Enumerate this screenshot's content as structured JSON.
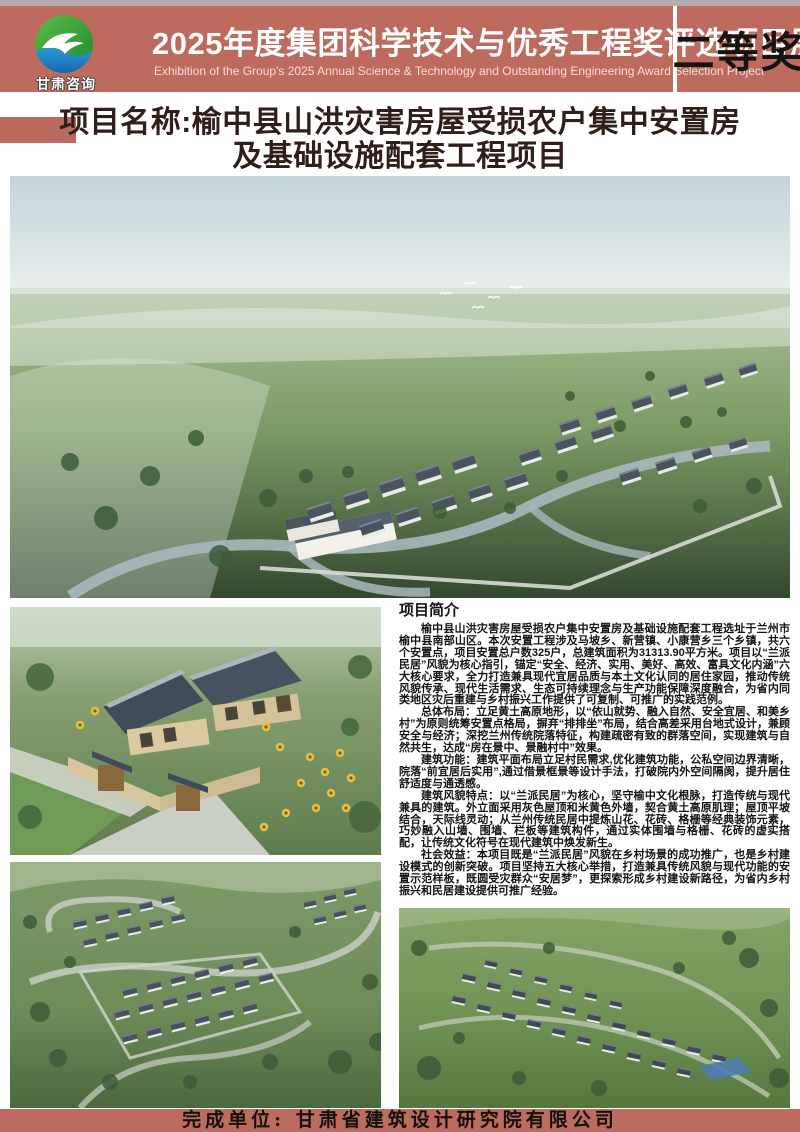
{
  "header": {
    "logo_text": "甘肃咨询",
    "title": "2025年度集团科学技术与优秀工程奖评选项目展",
    "subtitle_en": "Exhibition of the Group's 2025 Annual Science & Technology and Outstanding Engineering Award Selection Project",
    "award": "二等奖"
  },
  "project_title": {
    "line1": "项目名称:榆中县山洪灾害房屋受损农户集中安置房",
    "line2": "及基础设施配套工程项目"
  },
  "intro": {
    "heading": "项目简介",
    "paragraphs": [
      "榆中县山洪灾害房屋受损农户集中安置房及基础设施配套工程选址于兰州市榆中县南部山区。本次安置工程涉及马坡乡、新营镇、小康营乡三个乡镇，共六个安置点，项目安置总户数325户，总建筑面积为31313.90平方米。项目以“兰派民居”风貌为核心指引，锚定“安全、经济、实用、美好、高效、富具文化内涵”六大核心要求，全力打造兼具现代宜居品质与本土文化认同的居住家园，推动传统风貌传承、现代生活需求、生态可持续理念与生产功能保障深度融合，为省内同类地区灾后重建与乡村振兴工作提供了可复制、可推广的实践范例。",
      "总体布局：立足黄土高原地形，以“依山就势、融入自然、安全宜居、和美乡村”为原则统筹安置点格局，摒弃“排排坐”布局，结合高差采用台地式设计，兼顾安全与经济；深挖兰州传统院落特征，构建疏密有致的群落空间，实现建筑与自然共生，达成“房在景中、景融村中”效果。",
      "建筑功能：建筑平面布局立足村民需求,优化建筑功能，公私空间边界清晰，院落“前宜居后实用”,通过借景框景等设计手法，打破院内外空间隔阂，提升居住舒适度与通透感。",
      "建筑风貌特点：以“兰派民居”为核心，坚守榆中文化根脉，打造传统与现代兼具的建筑。外立面采用灰色屋顶和米黄色外墙，契合黄土高原肌理；屋顶平坡结合，天际线灵动；从兰州传统民居中提炼山花、花砖、格栅等经典装饰元素，巧妙融入山墙、围墙、栏板等建筑构件，通过实体围墙与格栅、花砖的虚实搭配，让传统文化符号在现代建筑中焕发新生。",
      "社会效益：本项目既是“兰派民居”风貌在乡村场景的成功推广，也是乡村建设模式的创新突破。项目坚持五大核心举措，打造兼具传统风貌与现代功能的安置示范样板，既圆受灾群众“安居梦”，更探索形成乡村建设新路径，为省内乡村振兴和民居建设提供可推广经验。"
    ]
  },
  "footer": {
    "text": "完成单位: 甘肃省建筑设计研究院有限公司"
  },
  "colors": {
    "banner_red": "#bd6b5f",
    "accent_bar_red": "#b96a5f",
    "title_text": "#2f1e19",
    "award_text": "#161413",
    "logo_green": "#3aa33c",
    "logo_blue": "#1e7fc2"
  }
}
